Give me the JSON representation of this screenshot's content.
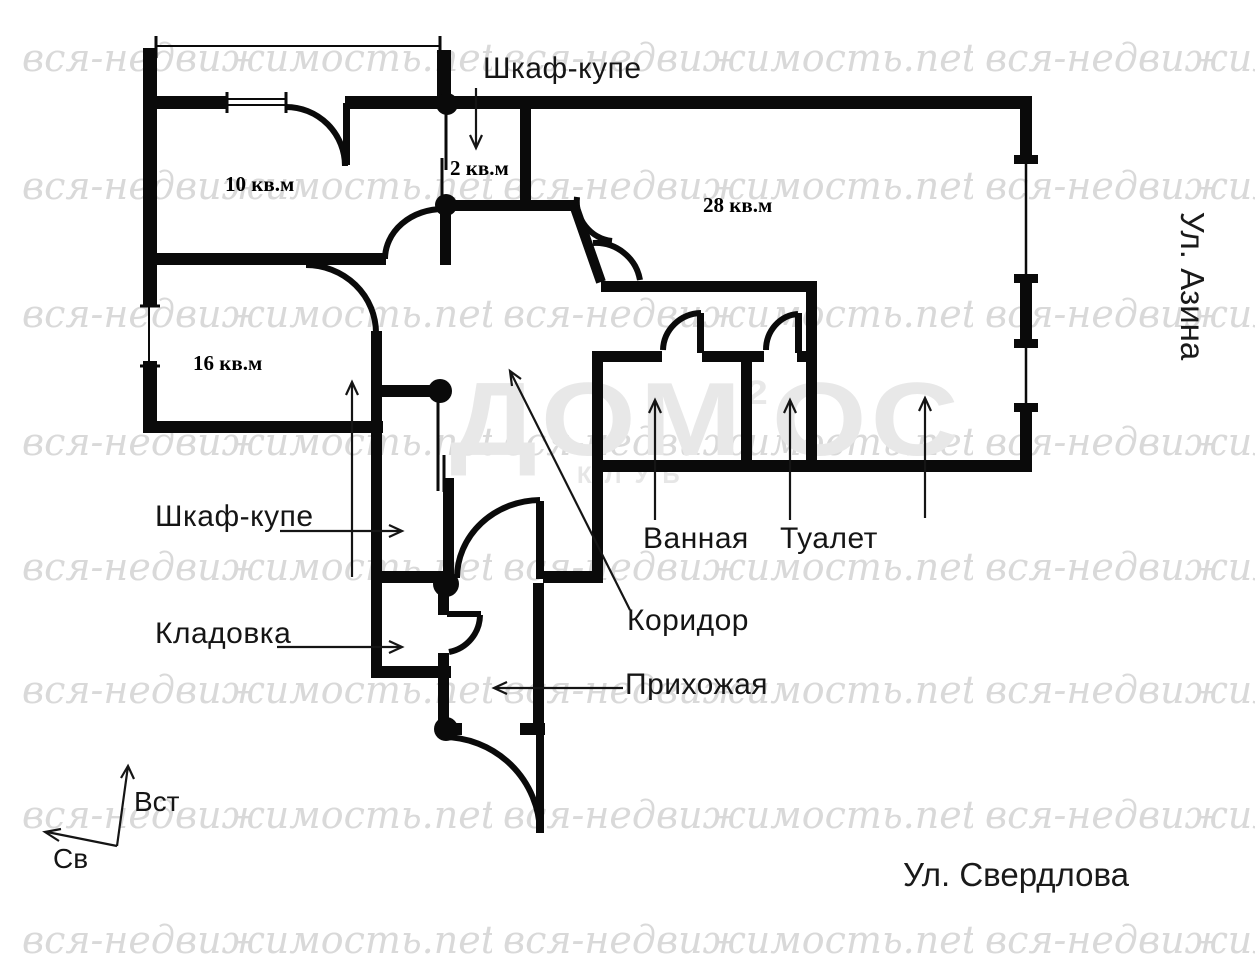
{
  "plan": {
    "rooms": {
      "room10": {
        "area_label": "10 кв.м"
      },
      "room16": {
        "area_label": "16 кв.м"
      },
      "room28": {
        "area_label": "28 кв.м"
      },
      "closet2": {
        "area_label": "2 кв.м"
      }
    },
    "labels": {
      "wardrobe_top": "Шкаф-купе",
      "wardrobe_left": "Шкаф-купе",
      "storage": "Кладовка",
      "bathroom": "Ванная",
      "toilet": "Туалет",
      "corridor": "Коридор",
      "hallway": "Прихожая"
    },
    "streets": {
      "right": "Ул. Азина",
      "bottom": "Ул. Свердлова"
    },
    "compass": {
      "up": "Вст",
      "left": "Св"
    },
    "colors": {
      "wall": "#0a0a0a",
      "watermark": "#d9d9d9",
      "logo": "#e8e8e8"
    }
  },
  "watermark": {
    "site": "вся-недвижимость.net",
    "logo": {
      "left": "ДОМ",
      "sup": "2",
      "right": "ОС",
      "sub": "КЛУБ"
    }
  }
}
